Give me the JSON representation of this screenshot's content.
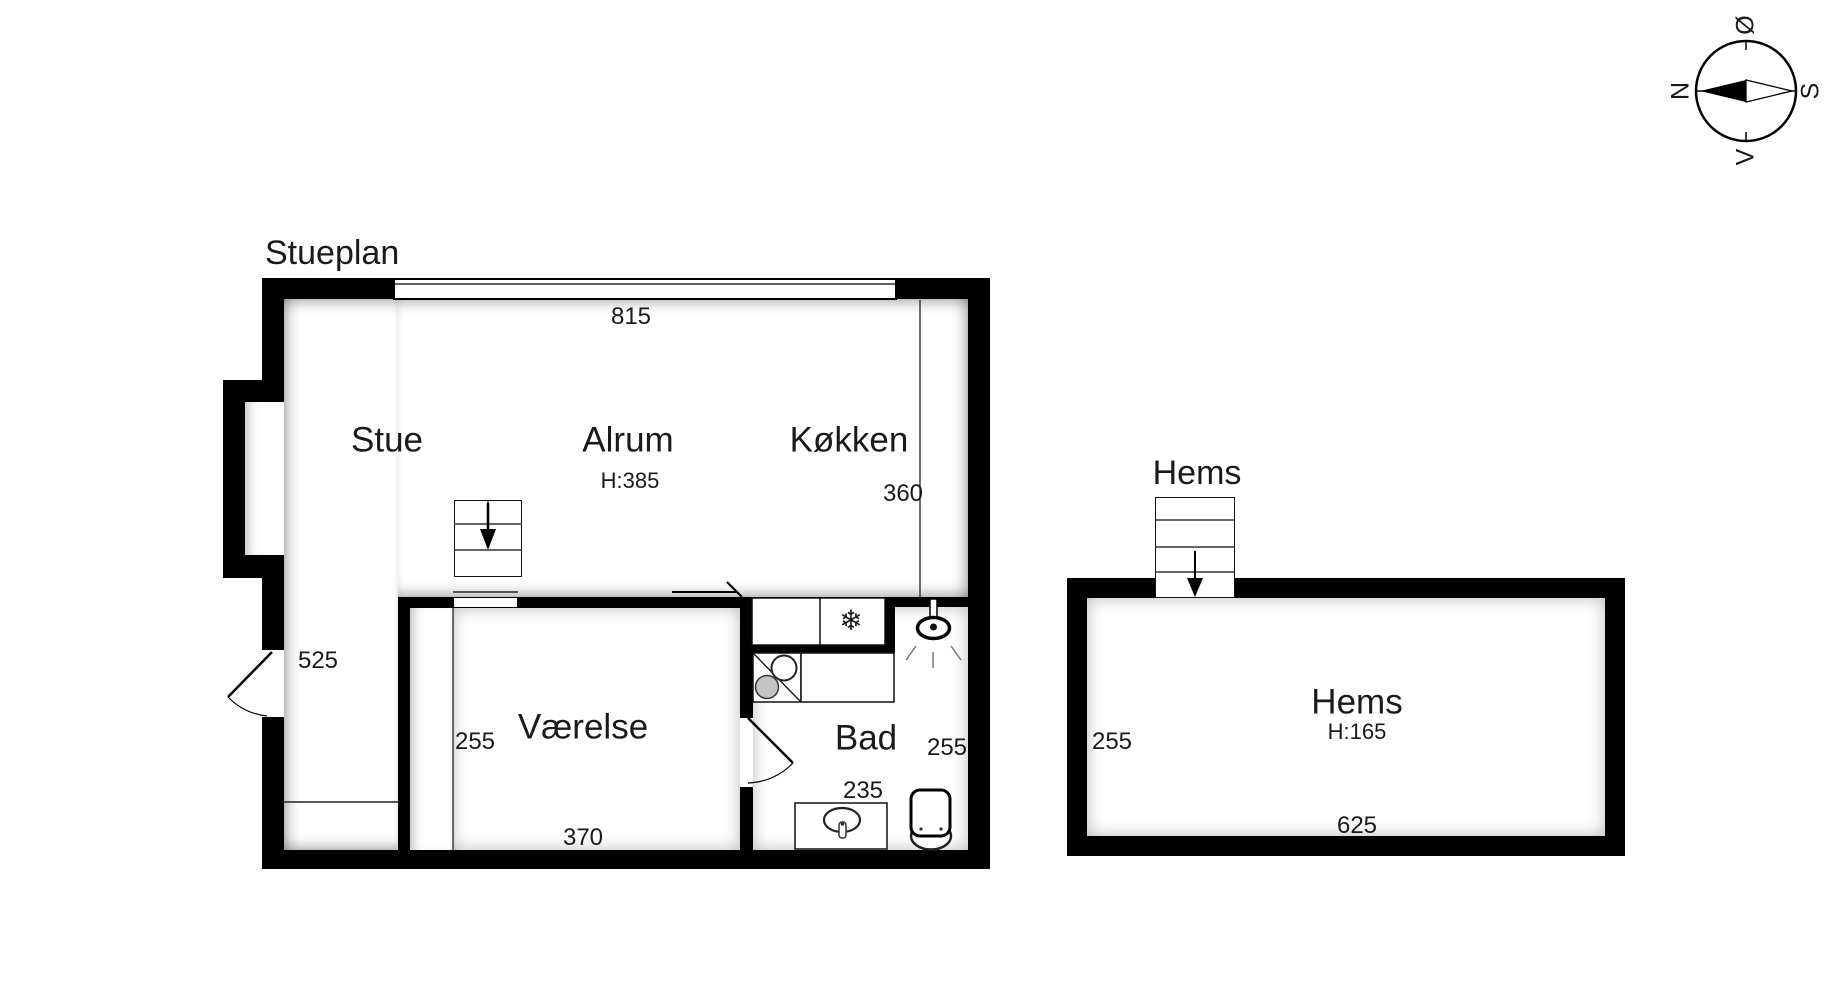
{
  "page": {
    "background": "#ffffff",
    "wall_color": "#000000",
    "text_color": "#1a1a1a"
  },
  "compass": {
    "n": "N",
    "e": "Ø",
    "s": "S",
    "w": "V"
  },
  "floorplan": {
    "title": "Stueplan",
    "rooms": {
      "stue": {
        "label": "Stue"
      },
      "alrum": {
        "label": "Alrum",
        "ceiling_height": "H:385"
      },
      "koekken": {
        "label": "Køkken"
      },
      "vaerelse": {
        "label": "Værelse"
      },
      "bad": {
        "label": "Bad"
      }
    },
    "dimensions": {
      "window_width": "815",
      "koekken_width": "360",
      "stue_height": "525",
      "vaerelse_height": "255",
      "vaerelse_width": "370",
      "bad_height": "255",
      "bad_width": "235"
    },
    "glyphs": {
      "snowflake": "❄"
    }
  },
  "loft": {
    "title": "Hems",
    "room": {
      "label": "Hems",
      "ceiling_height": "H:165"
    },
    "dimensions": {
      "height": "255",
      "width": "625"
    }
  }
}
